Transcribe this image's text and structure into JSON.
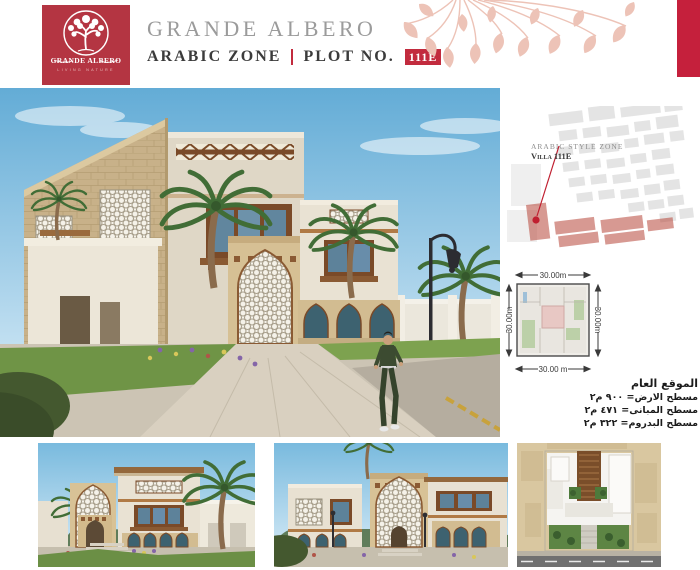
{
  "header": {
    "brand_title": "GRANDE ALBERO",
    "zone_label": "ARABIC ZONE",
    "divider": "|",
    "plot_label": "PLOT NO.",
    "plot_number": "111E",
    "logo": {
      "name": "GRANDE ALBERO",
      "tagline": "LIVING NATURE"
    }
  },
  "site_map": {
    "zone_label": "ARABIC STYLE ZONE",
    "villa_label": "Villa 111E"
  },
  "plot_diagram": {
    "dim_top": "30.00m",
    "dim_left": "30.00m",
    "dim_right": "30.00m",
    "dim_bottom": "30.00 m"
  },
  "location_info": {
    "heading": "الموقع العام",
    "line_land": "مسطح الارض= ٩٠٠ م٢",
    "line_buildings": "مسطح المبانى= ٤٧١ م٢",
    "line_basement": "مسطح البدروم= ٣٢٢ م٢"
  },
  "icons": {
    "logo_tree": "tree-in-circle",
    "ornament": "hanging-leaves"
  },
  "colors": {
    "brand_red": "#b43542",
    "badge_red": "#c22b3e",
    "accent_bar_red": "#c5203c",
    "leaf_pink": "#edc3b7",
    "title_gray": "#9b9b9b",
    "subtitle_dark": "#3b3b3b",
    "map_marker_red": "#c01f30"
  }
}
